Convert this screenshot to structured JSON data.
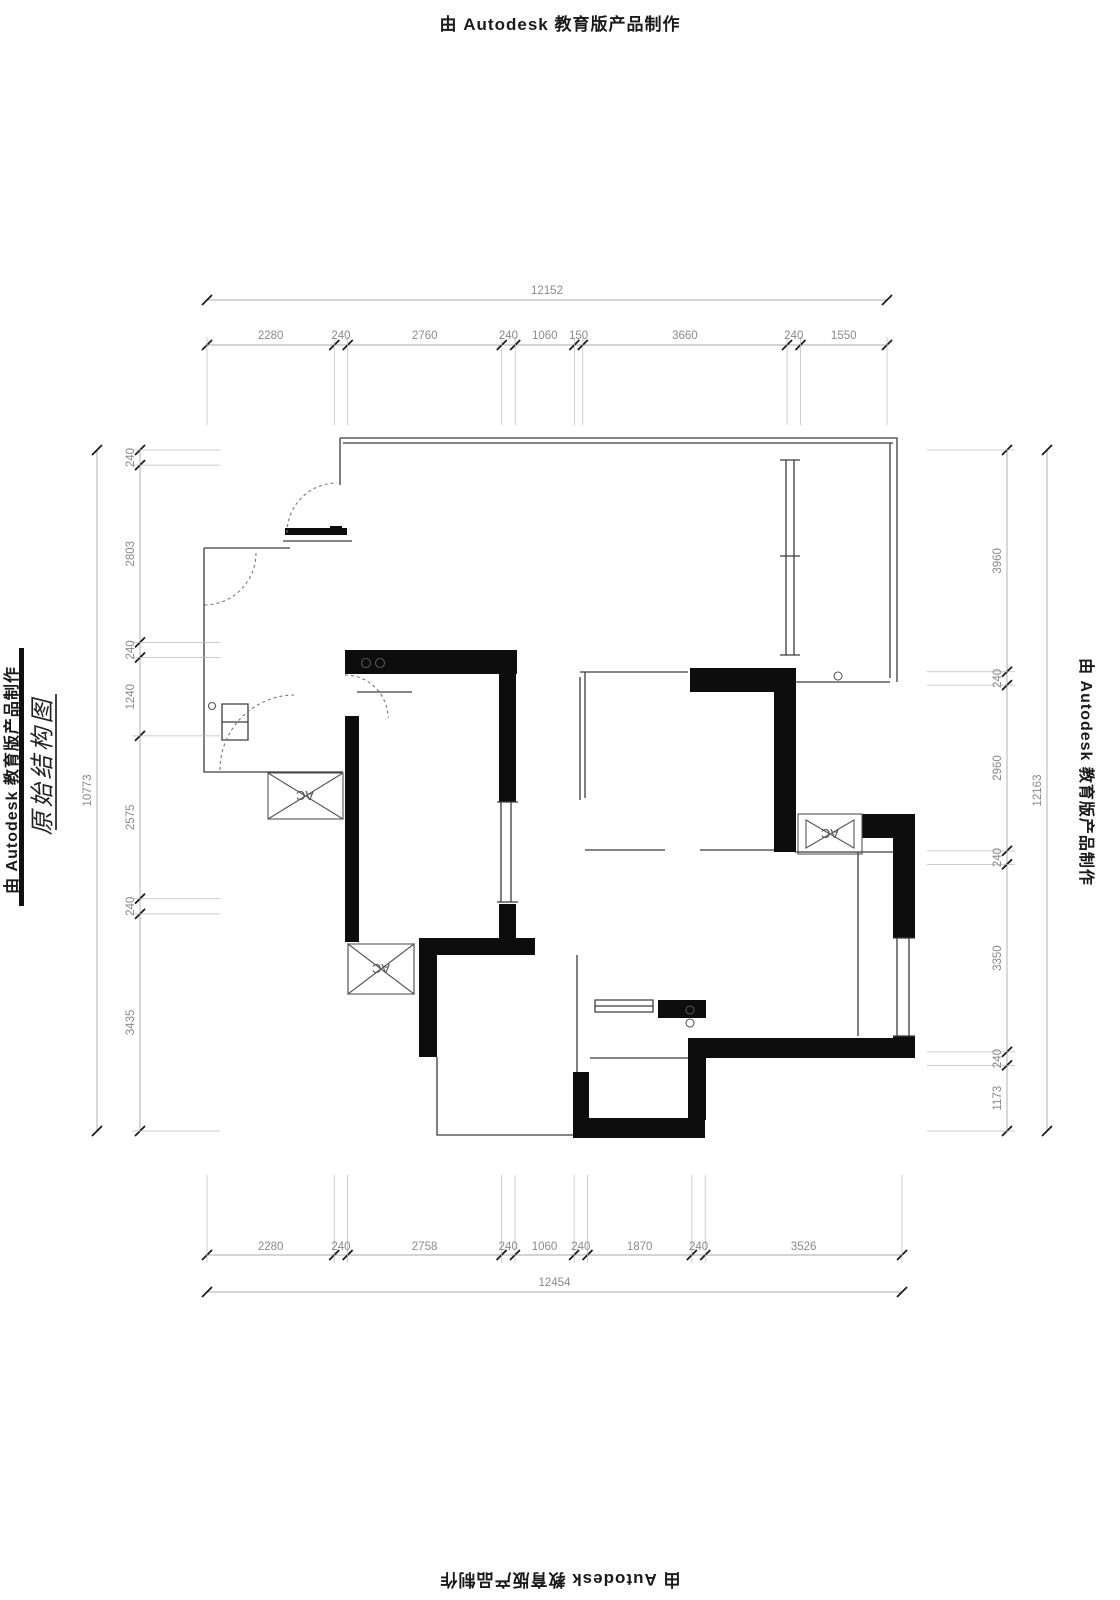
{
  "page": {
    "background": "#ffffff"
  },
  "stamps": {
    "top": "由 Autodesk 教育版产品制作",
    "bottom": "由 Autodesk 教育版产品制作",
    "left": "由 Autodesk 教育版产品制作",
    "right": "由 Autodesk 教育版产品制作"
  },
  "title": {
    "text": "原始结构图"
  },
  "plan": {
    "ac_label": "AC"
  },
  "dims": {
    "top": {
      "total": "12152",
      "segments": [
        "2280",
        "240",
        "2760",
        "240",
        "1060",
        "150",
        "3660",
        "240",
        "1550"
      ]
    },
    "bottom": {
      "total": "12454",
      "segments": [
        "2280",
        "240",
        "2758",
        "240",
        "1060",
        "240",
        "1870",
        "240",
        "3526"
      ]
    },
    "left": {
      "total": "10773",
      "segments": [
        "240",
        "2803",
        "240",
        "1240",
        "2575",
        "240",
        "3435"
      ]
    },
    "right": {
      "total": "12163",
      "segments": [
        "3960",
        "240",
        "2960",
        "240",
        "3350",
        "240",
        "1173"
      ]
    }
  },
  "colors": {
    "wall_fill": "#0d0d0d",
    "thin_line": "#3c3c3c",
    "dim_text": "#8a8a8a",
    "dim_line": "#aaaaaa",
    "tick": "#1a1a1a",
    "stamp_text": "#1a1a1a"
  }
}
